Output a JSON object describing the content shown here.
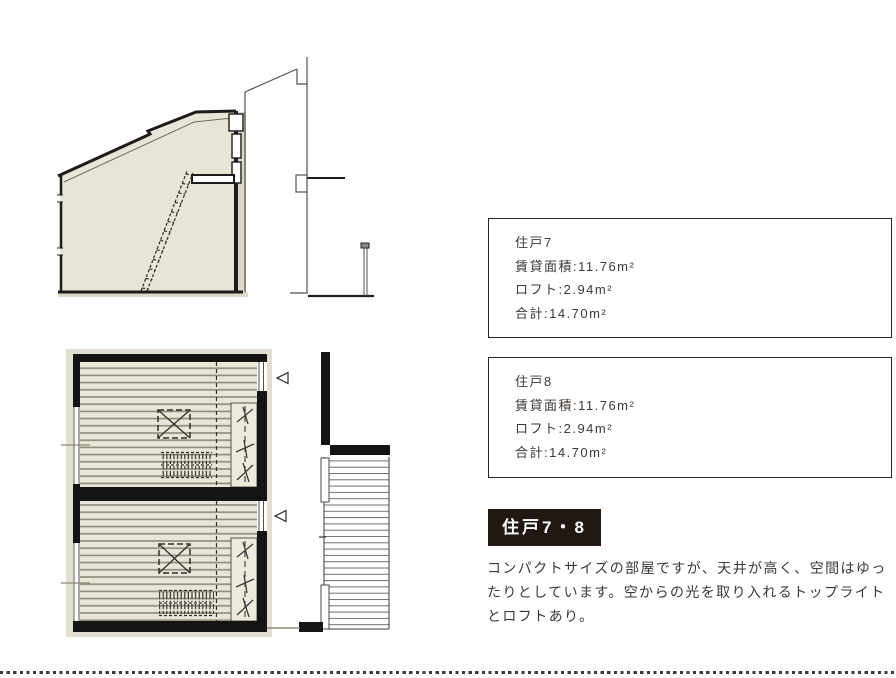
{
  "unit_boxes": [
    {
      "title": "住戸7",
      "rows": [
        "賃貸面積:11.76m²",
        "ロフト:2.94m²",
        "合計:14.70m²"
      ]
    },
    {
      "title": "住戸8",
      "rows": [
        "賃貸面積:11.76m²",
        "ロフト:2.94m²",
        "合計:14.70m²"
      ]
    }
  ],
  "section_heading": "住戸7・8",
  "description": {
    "line1": "コンパクトサイズの部屋ですが、天井が高く、空間はゆっ",
    "line2": "たりとしています。空からの光を取り入れるトップライト",
    "line3": "とロフトあり。"
  },
  "drawings": {
    "cross_section": "unit cross-section with sloped ceiling, loft and ladder",
    "floor_plan": "stacked plans of unit 7 and unit 8 with shared outdoor deck",
    "symbols": [
      "skylight-symbol",
      "loft-ladder-hatch",
      "entrance-direction-triangle"
    ]
  },
  "colors": {
    "heading_background": "#211814",
    "heading_text": "#ffffff",
    "body_text": "#3d3835",
    "box_border": "#2a2423",
    "plan_fill": "#e9e5d7",
    "wall": "#141414",
    "floor_line": "#8d8a79",
    "dotted_separator": "#3b3b3b"
  }
}
